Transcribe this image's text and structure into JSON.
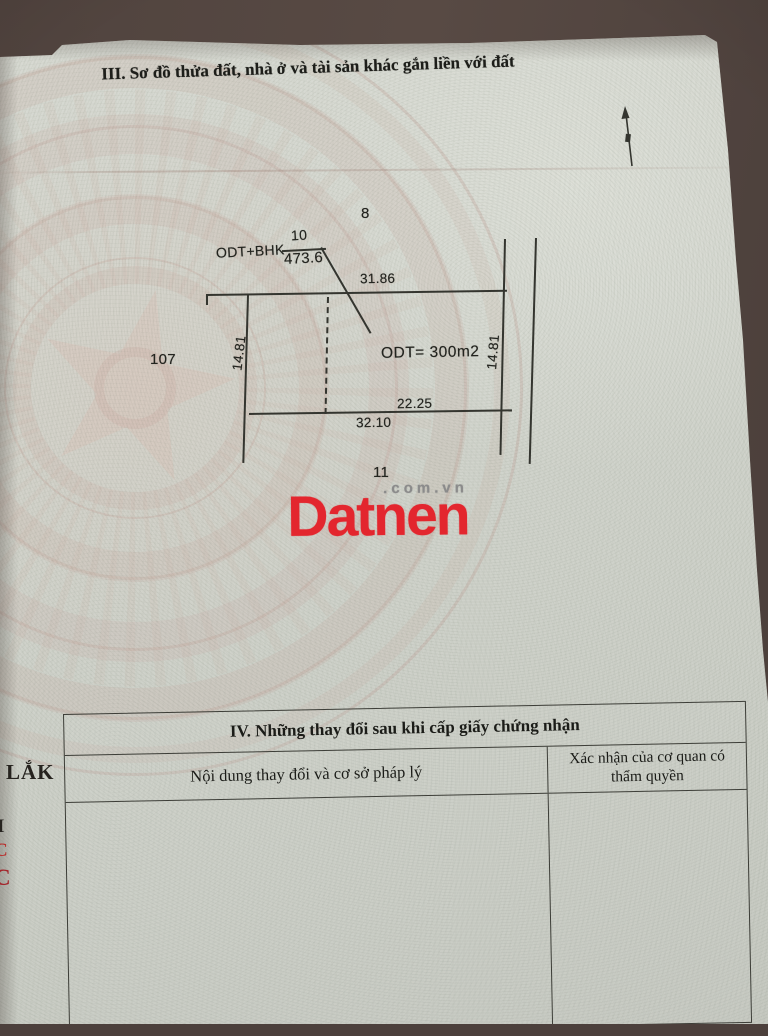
{
  "sections": {
    "section3_title": "III. Sơ đồ thửa đất, nhà ở và tài sản khác gắn liền với đất"
  },
  "diagram": {
    "adjacent_parcel_top": "8",
    "adjacent_parcel_left": "107",
    "adjacent_parcel_bottom": "11",
    "parcel_number": "10",
    "parcel_area": "473.6",
    "land_use_code": "ODT+BHK",
    "inner_area_label": "ODT= 300m2",
    "dim_top": "31.86",
    "dim_left": "14.81",
    "dim_right": "14.81",
    "dim_bottom_inner": "22.25",
    "dim_bottom_outer": "32.10",
    "north_arrow_icon": "north-arrow",
    "line_color": "#34352f"
  },
  "watermark": {
    "brand": "Datnen",
    "suffix": ".com.vn",
    "brand_color": "#e3262e",
    "suffix_color": "#8b8b8b"
  },
  "section4_table": {
    "title": "IV. Những thay đổi sau khi cấp giấy chứng nhận",
    "columns": [
      "Nội dung thay đổi và cơ sở pháp lý",
      "Xác nhận của cơ quan có thẩm quyền"
    ],
    "rows": []
  },
  "left_edge_fragments": {
    "f1": "LẮK",
    "f2": "I",
    "f3": "C",
    "f4": "C"
  }
}
